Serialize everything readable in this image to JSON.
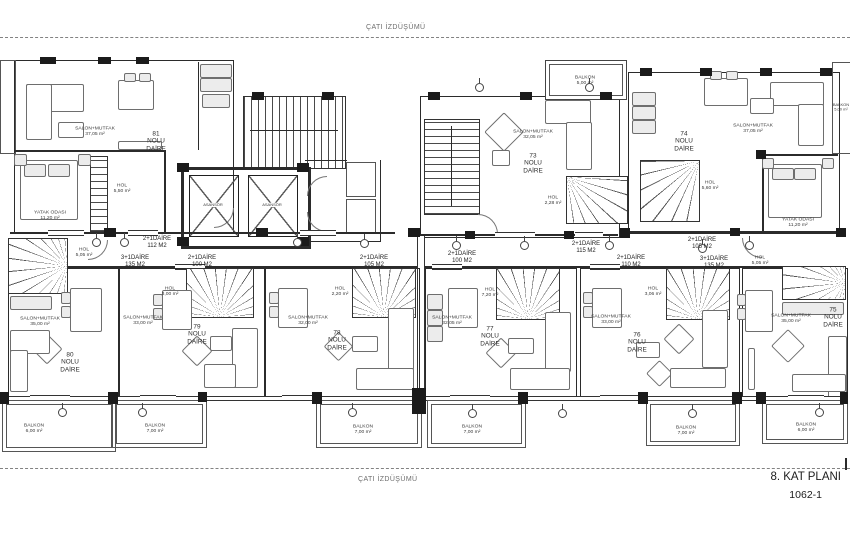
{
  "sheet": {
    "top_projection": "ÇATI İZDÜŞÜMÜ",
    "bottom_projection": "ÇATI İZDÜŞÜMÜ",
    "title": "8. KAT PLANI",
    "number": "1062-1"
  },
  "colors": {
    "line": "#2b2b2b",
    "muted": "#6e6e6e"
  },
  "elevator_label": "ASANSÖR",
  "apartments": {
    "a81": {
      "name": "81\nNOLU\nDAİRE",
      "salon": "SALON+MUTFAK\n37,05 m²",
      "bedroom": "YATAK ODASI\n11,20 m²",
      "hol": "HOL\n5,50 m²"
    },
    "a73": {
      "name": "73\nNOLU\nDAİRE",
      "salon": "SALON+MUTFAK\n32,05 m²",
      "hol": "HOL\n2,28 m²",
      "balkon": "BALKON\n5,00 m²"
    },
    "a74": {
      "name": "74\nNOLU\nDAİRE",
      "salon": "SALON+MUTFAK\n37,05 m²",
      "hol": "HOL\n5,60 m²",
      "bedroom": "YATAK ODASI\n11,20 m²",
      "balkon": "BALKON\n5,00 m²"
    },
    "a80": {
      "name": "80\nNOLU\nDAİRE",
      "salon": "SALON+MUTFAK\n35,00 m²",
      "hol": "HOL\n5,05 m²",
      "balkon": "BALKON\n6,00 m²"
    },
    "a79": {
      "name": "79\nNOLU\nDAİRE",
      "salon": "SALON+MUTFAK\n33,00 m²",
      "hol": "HOL\n3,00 m²",
      "balkon": "BALKON\n7,00 m²"
    },
    "a78": {
      "name": "78\nNOLU\nDAİRE",
      "salon": "SALON+MUTFAK\n32,00 m²",
      "hol": "HOL\n2,20 m²",
      "balkon": "BALKON\n7,00 m²"
    },
    "a77": {
      "name": "77\nNOLU\nDAİRE",
      "salon": "SALON+MUTFAK\n32,05 m²",
      "hol": "HOL\n7,20 m²",
      "balkon": "BALKON\n7,00 m²"
    },
    "a76": {
      "name": "76\nNOLU\nDAİRE",
      "salon": "SALON+MUTFAK\n33,00 m²",
      "hol": "HOL\n3,06 m²",
      "balkon": "BALKON\n7,00 m²"
    },
    "a75": {
      "name": "75\nNOLU\nDAİRE",
      "salon": "SALON+MUTFAK\n35,00 m²",
      "hol": "HOL\n5,05 m²",
      "balkon": "BALKON\n6,00 m²"
    }
  },
  "unit_sizes": {
    "left_112": "2+1DAİRE\n112 M2",
    "left_135": "3+1DAİRE\n135 M2",
    "left_100": "2+1DAİRE\n100 M2",
    "left_105": "2+1DAİRE\n105 M2",
    "right_100": "2+1DAİRE\n100 M2",
    "right_115": "2+1DAİRE\n115 M2",
    "right_110": "2+1DAİRE\n110 M2",
    "right_105": "2+1DAİRE\n105 M2",
    "right_135": "3+1DAİRE\n135 M2"
  }
}
